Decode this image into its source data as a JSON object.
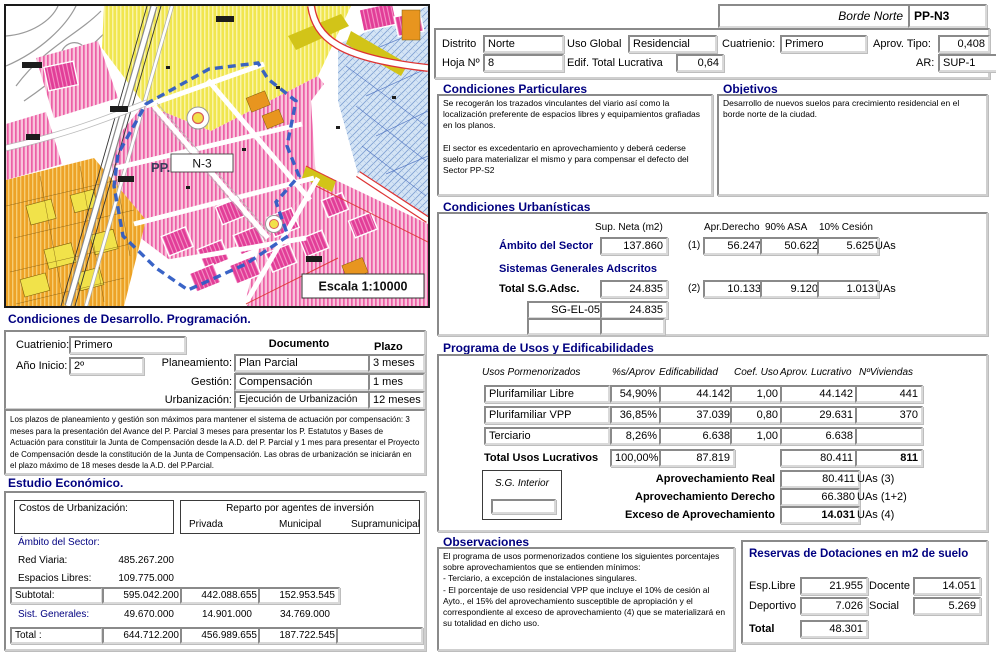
{
  "map": {
    "pp_prefix": "PP.",
    "sector_code": "N-3",
    "scale": "Escala 1:10000",
    "boundary_color": "#2f5cc4"
  },
  "header": {
    "title": "Borde Norte",
    "code": "PP-N3",
    "distrito_label": "Distrito",
    "distrito": "Norte",
    "uso_global_label": "Uso Global",
    "uso_global": "Residencial",
    "cuatrienio_label": "Cuatrienio:",
    "cuatrienio": "Primero",
    "aprov_tipo_label": "Aprov. Tipo:",
    "aprov_tipo": "0,408",
    "hoja_label": "Hoja Nº",
    "hoja": "8",
    "edif_label": "Edif. Total Lucrativa",
    "edif": "0,64",
    "ar_label": "AR:",
    "ar": "SUP-1"
  },
  "particulares": {
    "title": "Condiciones Particulares",
    "text": "Se recogerán los trazados vinculantes del viario así como la localización preferente de espacios libres y equipamientos grafiadas en los planos.\n\nEl sector es excedentario en aprovechamiento y deberá cederse suelo para materializar el mismo y  para compensar el defecto del Sector PP-S2"
  },
  "objetivos": {
    "title": "Objetivos",
    "text": "Desarrollo de nuevos suelos para crecimiento residencial en el borde norte de la ciudad."
  },
  "urbanisticas": {
    "title": "Condiciones Urbanísticas",
    "col_sup": "Sup. Neta (m2)",
    "col_apr": "Apr.Derecho",
    "col_asa": "90% ASA",
    "col_cesion": "10% Cesión",
    "ambito_label": "Ámbito del Sector",
    "ambito_sup": "137.860",
    "ambito_ref": "(1)",
    "ambito_apr": "56.247",
    "ambito_asa": "50.622",
    "ambito_cesion": "5.625",
    "uas": "UAs",
    "sg_title": "Sistemas Generales  Adscritos",
    "total_label": "Total S.G.Adsc.",
    "total_sup": "24.835",
    "total_ref": "(2)",
    "total_apr": "10.133",
    "total_asa": "9.120",
    "total_cesion": "1.013",
    "sg_code": "SG-EL-05",
    "sg_value": "24.835"
  },
  "desarrollo": {
    "title": "Condiciones de Desarrollo. Programación.",
    "cuatrienio_label": "Cuatrienio:",
    "cuatrienio": "Primero",
    "anio_label": "Año Inicio:",
    "anio": "2º",
    "doc_header": "Documento",
    "plazo_header": "Plazo",
    "rows": [
      {
        "label": "Planeamiento:",
        "doc": "Plan Parcial",
        "plazo": "3 meses"
      },
      {
        "label": "Gestión:",
        "doc": "Compensación",
        "plazo": "1 mes"
      },
      {
        "label": "Urbanización:",
        "doc": "Ejecución de Urbanización",
        "plazo": "12 meses"
      }
    ],
    "note": "Los plazos de planeamiento y gestión son máximos para mantener el sistema de actuación por compensación: 3 meses para la presentación del Avance del P. Parcial 3 meses para presentar los P. Estatutos y Bases de Actuación para constituir la Junta de Compensación desde la A.D. del P. Parcial y 1 mes para presentar el Proyecto de Compensación desde la constitución de la Junta de Compensación.  Las obras de urbanización se iniciarán en el plazo máximo de 18 meses desde la A.D. del P.Parcial."
  },
  "estudio": {
    "title": "Estudio Económico.",
    "costos_label": "Costos de Urbanización:",
    "reparto_title": "Reparto por agentes de inversión",
    "col_privada": "Privada",
    "col_municipal": "Municipal",
    "col_supra": "Supramunicipal",
    "ambito_label": "Ámbito del Sector:",
    "red_viaria_label": "Red Viaria:",
    "red_viaria": "485.267.200",
    "espacios_label": "Espacios Libres:",
    "espacios": "109.775.000",
    "subtotal_label": "Subtotal:",
    "subtotal": "595.042.200",
    "subtotal_privada": "442.088.655",
    "subtotal_municipal": "152.953.545",
    "sist_label": "Sist. Generales:",
    "sist": "49.670.000",
    "sist_privada": "14.901.000",
    "sist_municipal": "34.769.000",
    "total_label": "Total :",
    "total": "644.712.200",
    "total_privada": "456.989.655",
    "total_municipal": "187.722.545"
  },
  "programa": {
    "title": "Programa de Usos y Edificabilidades",
    "h_usos": "Usos Pormenorizados",
    "h_pct": "%s/Aprov",
    "h_edif": "Edificabilidad",
    "h_coef": "Coef. Uso",
    "h_aprov": "Aprov. Lucrativo",
    "h_viv": "NºViviendas",
    "rows": [
      {
        "uso": "Plurifamiliar Libre",
        "pct": "54,90%",
        "edif": "44.142",
        "coef": "1,00",
        "aprov": "44.142",
        "viv": "441"
      },
      {
        "uso": "Plurifamiliar VPP",
        "pct": "36,85%",
        "edif": "37.039",
        "coef": "0,80",
        "aprov": "29.631",
        "viv": "370"
      },
      {
        "uso": "Terciario",
        "pct": "8,26%",
        "edif": "6.638",
        "coef": "1,00",
        "aprov": "6.638",
        "viv": ""
      }
    ],
    "total_label": "Total Usos Lucrativos",
    "total_pct": "100,00%",
    "total_edif": "87.819",
    "total_aprov": "80.411",
    "total_viv": "811",
    "sg_interior_label": "S.G. Interior",
    "real_label": "Aprovechamiento Real",
    "real": "80.411",
    "real_unit": "UAs  (3)",
    "derecho_label": "Aprovechamiento  Derecho",
    "derecho": "66.380",
    "derecho_unit": "UAs (1+2)",
    "exceso_label": "Exceso de Aprovechamiento",
    "exceso": "14.031",
    "exceso_unit": "UAs (4)"
  },
  "observaciones": {
    "title": "Observaciones",
    "text": "El programa de usos pormenorizados contiene los siguientes porcentajes sobre aprovechamientos que se entienden mínimos:\n- Terciario, a excepción de instalaciones singulares.\n- El porcentaje de uso residencial VPP que incluye el 10% de cesión al Ayto., el 15% del aprovechamiento susceptible de apropiación y el correspondiente al exceso de aprovechamiento (4) que se materializará en su totalidad en dicho uso."
  },
  "reservas": {
    "title": "Reservas de Dotaciones en m2 de suelo",
    "esp_label": "Esp.Libre",
    "esp": "21.955",
    "docente_label": "Docente",
    "docente": "14.051",
    "deportivo_label": "Deportivo",
    "deportivo": "7.026",
    "social_label": "Social",
    "social": "5.269",
    "total_label": "Total",
    "total": "48.301"
  }
}
